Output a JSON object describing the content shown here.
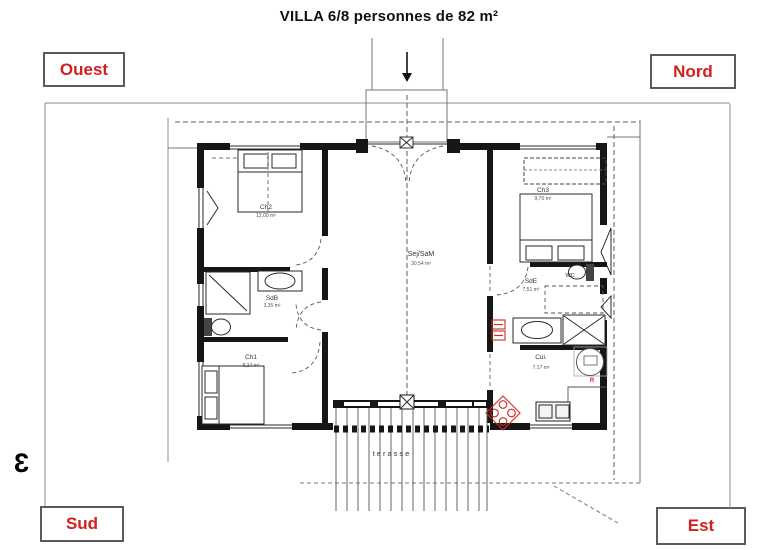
{
  "title": "VILLA 6/8 personnes de 82 m²",
  "compass": {
    "top_left": "Ouest",
    "top_right": "Nord",
    "bottom_left": "Sud",
    "bottom_right": "Est"
  },
  "edge_marker": "3",
  "colors": {
    "accent_red": "#d21f1f",
    "wall": "#161616",
    "thin_line": "#8c8c8c",
    "dash_line": "#5f5f5f",
    "fixture_red": "#cf2b24"
  },
  "rooms": {
    "ch1": {
      "name": "Ch1",
      "area": "8,24 m²"
    },
    "ch2": {
      "name": "Ch2",
      "area": "12,00 m²"
    },
    "ch3": {
      "name": "Ch3",
      "area": "9,70 m²"
    },
    "living": {
      "name": "Sej/SaM",
      "area": "30,54 m²"
    },
    "sdb": {
      "name": "SdB",
      "area": "3,35 m²"
    },
    "sde": {
      "name": "SdE",
      "area": "7,51 m²"
    },
    "wc": {
      "name": "WC"
    },
    "kitchen": {
      "name": "Cui.",
      "area": "7,17 m²"
    },
    "terrace": {
      "name": "terasse"
    }
  },
  "annotations": {
    "fridge": "R"
  }
}
